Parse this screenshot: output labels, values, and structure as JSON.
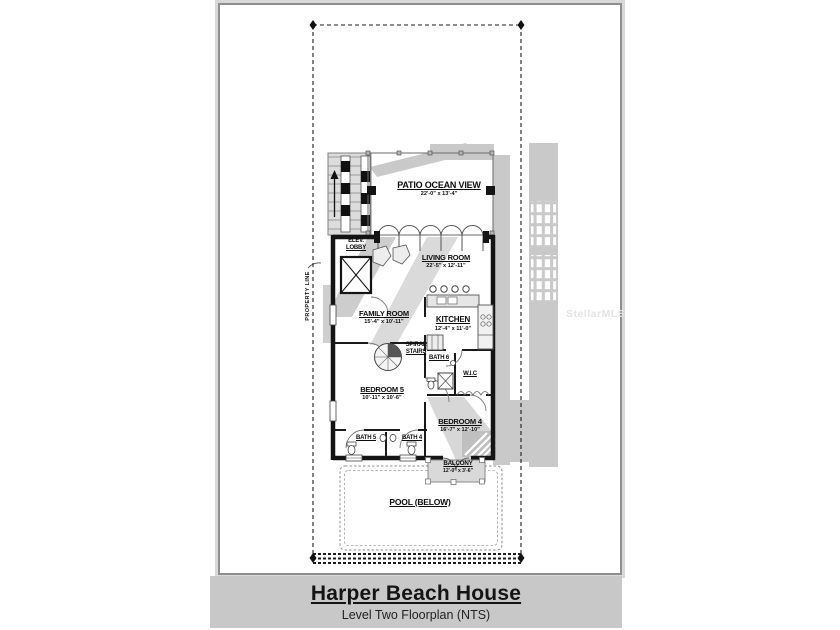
{
  "title_block": {
    "title": "Harper Beach House",
    "subtitle": "Level Two Floorplan (NTS)"
  },
  "annotations": {
    "property_line": "PROPERTY LINE",
    "watermark": "StellarMLS"
  },
  "rooms": {
    "patio": {
      "name": "PATIO OCEAN VIEW",
      "dims": "22'-0\" x 13'-4\""
    },
    "living": {
      "name": "LIVING ROOM",
      "dims": "22'-5\" x 12'-11\""
    },
    "family": {
      "name": "FAMILY ROOM",
      "dims": "15'-4\" x 10'-11\""
    },
    "kitchen": {
      "name": "KITCHEN",
      "dims": "12'-4\" x 11'-0\""
    },
    "bedroom5": {
      "name": "BEDROOM 5",
      "dims": "10'-11\" x 10'-6\""
    },
    "bedroom4": {
      "name": "BEDROOM 4",
      "dims": "16'-7\" x 12'-10\""
    },
    "balcony": {
      "name": "BALCONY",
      "dims": "12'-0\" x 3'-6\""
    },
    "pool": {
      "name": "POOL (BELOW)"
    },
    "elev_lobby": {
      "line1": "ELEV.",
      "line2": "LOBBY"
    },
    "spiral": {
      "line1": "SPIRAL",
      "line2": "STAIRS"
    },
    "bath6": {
      "name": "BATH 6"
    },
    "wic": {
      "name": "W.I.C"
    },
    "bath5": {
      "name": "BATH 5"
    },
    "bath4": {
      "name": "BATH 4"
    }
  },
  "colors": {
    "ghost_gray": "#c9c9c9",
    "title_band_gray": "#c8c8c8",
    "wall_black": "#141414",
    "paper_white": "#ffffff"
  }
}
